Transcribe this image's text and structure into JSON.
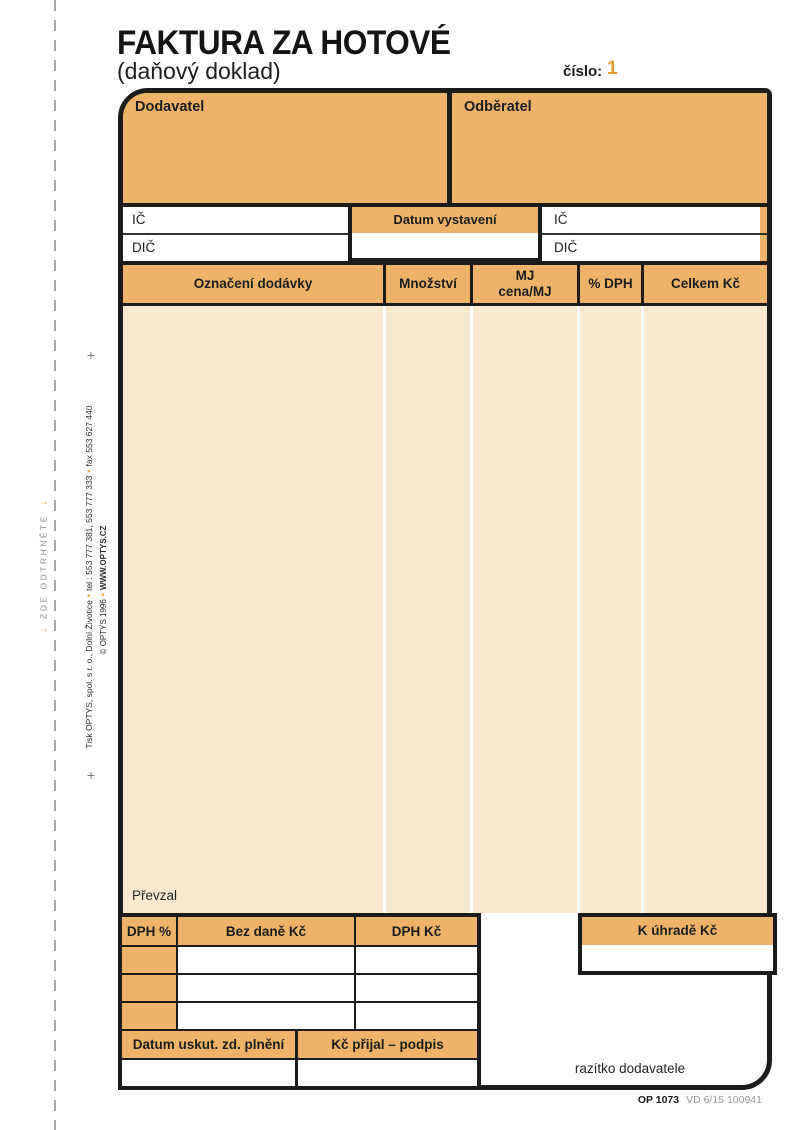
{
  "header": {
    "title": "FAKTURA ZA HOTOVÉ",
    "subtitle": "(daňový doklad)",
    "number_label": "číslo:",
    "number_value": "1"
  },
  "parties": {
    "supplier_label": "Dodavatel",
    "customer_label": "Odběratel"
  },
  "fields": {
    "ic_label": "IČ",
    "dic_label": "DIČ",
    "issue_date_label": "Datum vystavení"
  },
  "items_table": {
    "col_designation": "Označení dodávky",
    "col_quantity": "Množství",
    "col_unit_line1": "MJ",
    "col_unit_line2": "cena/MJ",
    "col_vat": "% DPH",
    "col_total": "Celkem Kč",
    "received_label": "Převzal"
  },
  "vat_summary": {
    "col_rate": "DPH %",
    "col_base": "Bez daně Kč",
    "col_vat": "DPH Kč",
    "total_label": "K úhradě Kč",
    "date_supply_label": "Datum uskut. zd. plnění",
    "received_sign_label": "Kč přijal – podpis",
    "stamp_label": "razítko dodavatele"
  },
  "footer": {
    "form_code": "OP 1073",
    "form_meta": "VD 6/15  100941"
  },
  "margin": {
    "plus_mark": "+",
    "tear_arrow": "↓",
    "tear_label": "ZDE ODTRHNĚTE",
    "bullet": "•",
    "print_info_1": "Tisk OPTYS, spol. s r. o., Dolní Životice",
    "print_info_2": "tel : 553 777 381, 553 777 333",
    "print_info_3": "fax 553 627 440",
    "copyright_text": "© OPTYS 1996",
    "copyright_site": "WWW.OPTYS.CZ"
  },
  "colors": {
    "accent_orange": "#edb469",
    "table_cream": "#f8e8cd",
    "number_orange": "#e79a2e"
  }
}
